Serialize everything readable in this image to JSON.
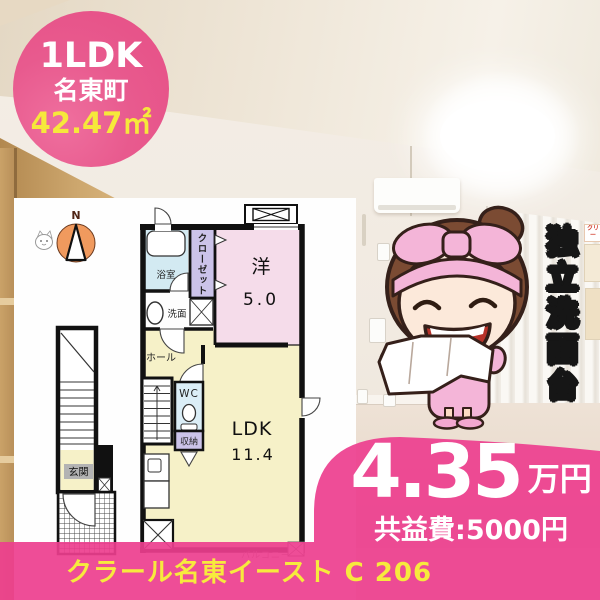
{
  "badge": {
    "layout": "1LDK",
    "town": "名東町",
    "area": "42.47㎡"
  },
  "feature_banner": {
    "text": "独立洗面台"
  },
  "photo": {
    "poster_label": "クリー"
  },
  "floorplan": {
    "compass_north": "N",
    "bath": "浴室",
    "closet": "クローゼット",
    "western_room": "洋",
    "western_room_size": "5.0",
    "washroom": "洗面",
    "hall": "ホール",
    "toilet": "WC",
    "storage": "収納",
    "living": "LDK",
    "living_size": "11.4",
    "entrance": "玄関",
    "balcony": "バルコニー"
  },
  "pricing": {
    "rent": "4.35",
    "rent_unit": "万円",
    "common_fee": "共益費:5000円"
  },
  "footer": {
    "property_name": "クラール名東イースト C 206"
  },
  "colors": {
    "accent_pink": "#ed3e8e",
    "highlight_yellow": "#f7ea3d",
    "badge_pink": "#e85a8e"
  }
}
